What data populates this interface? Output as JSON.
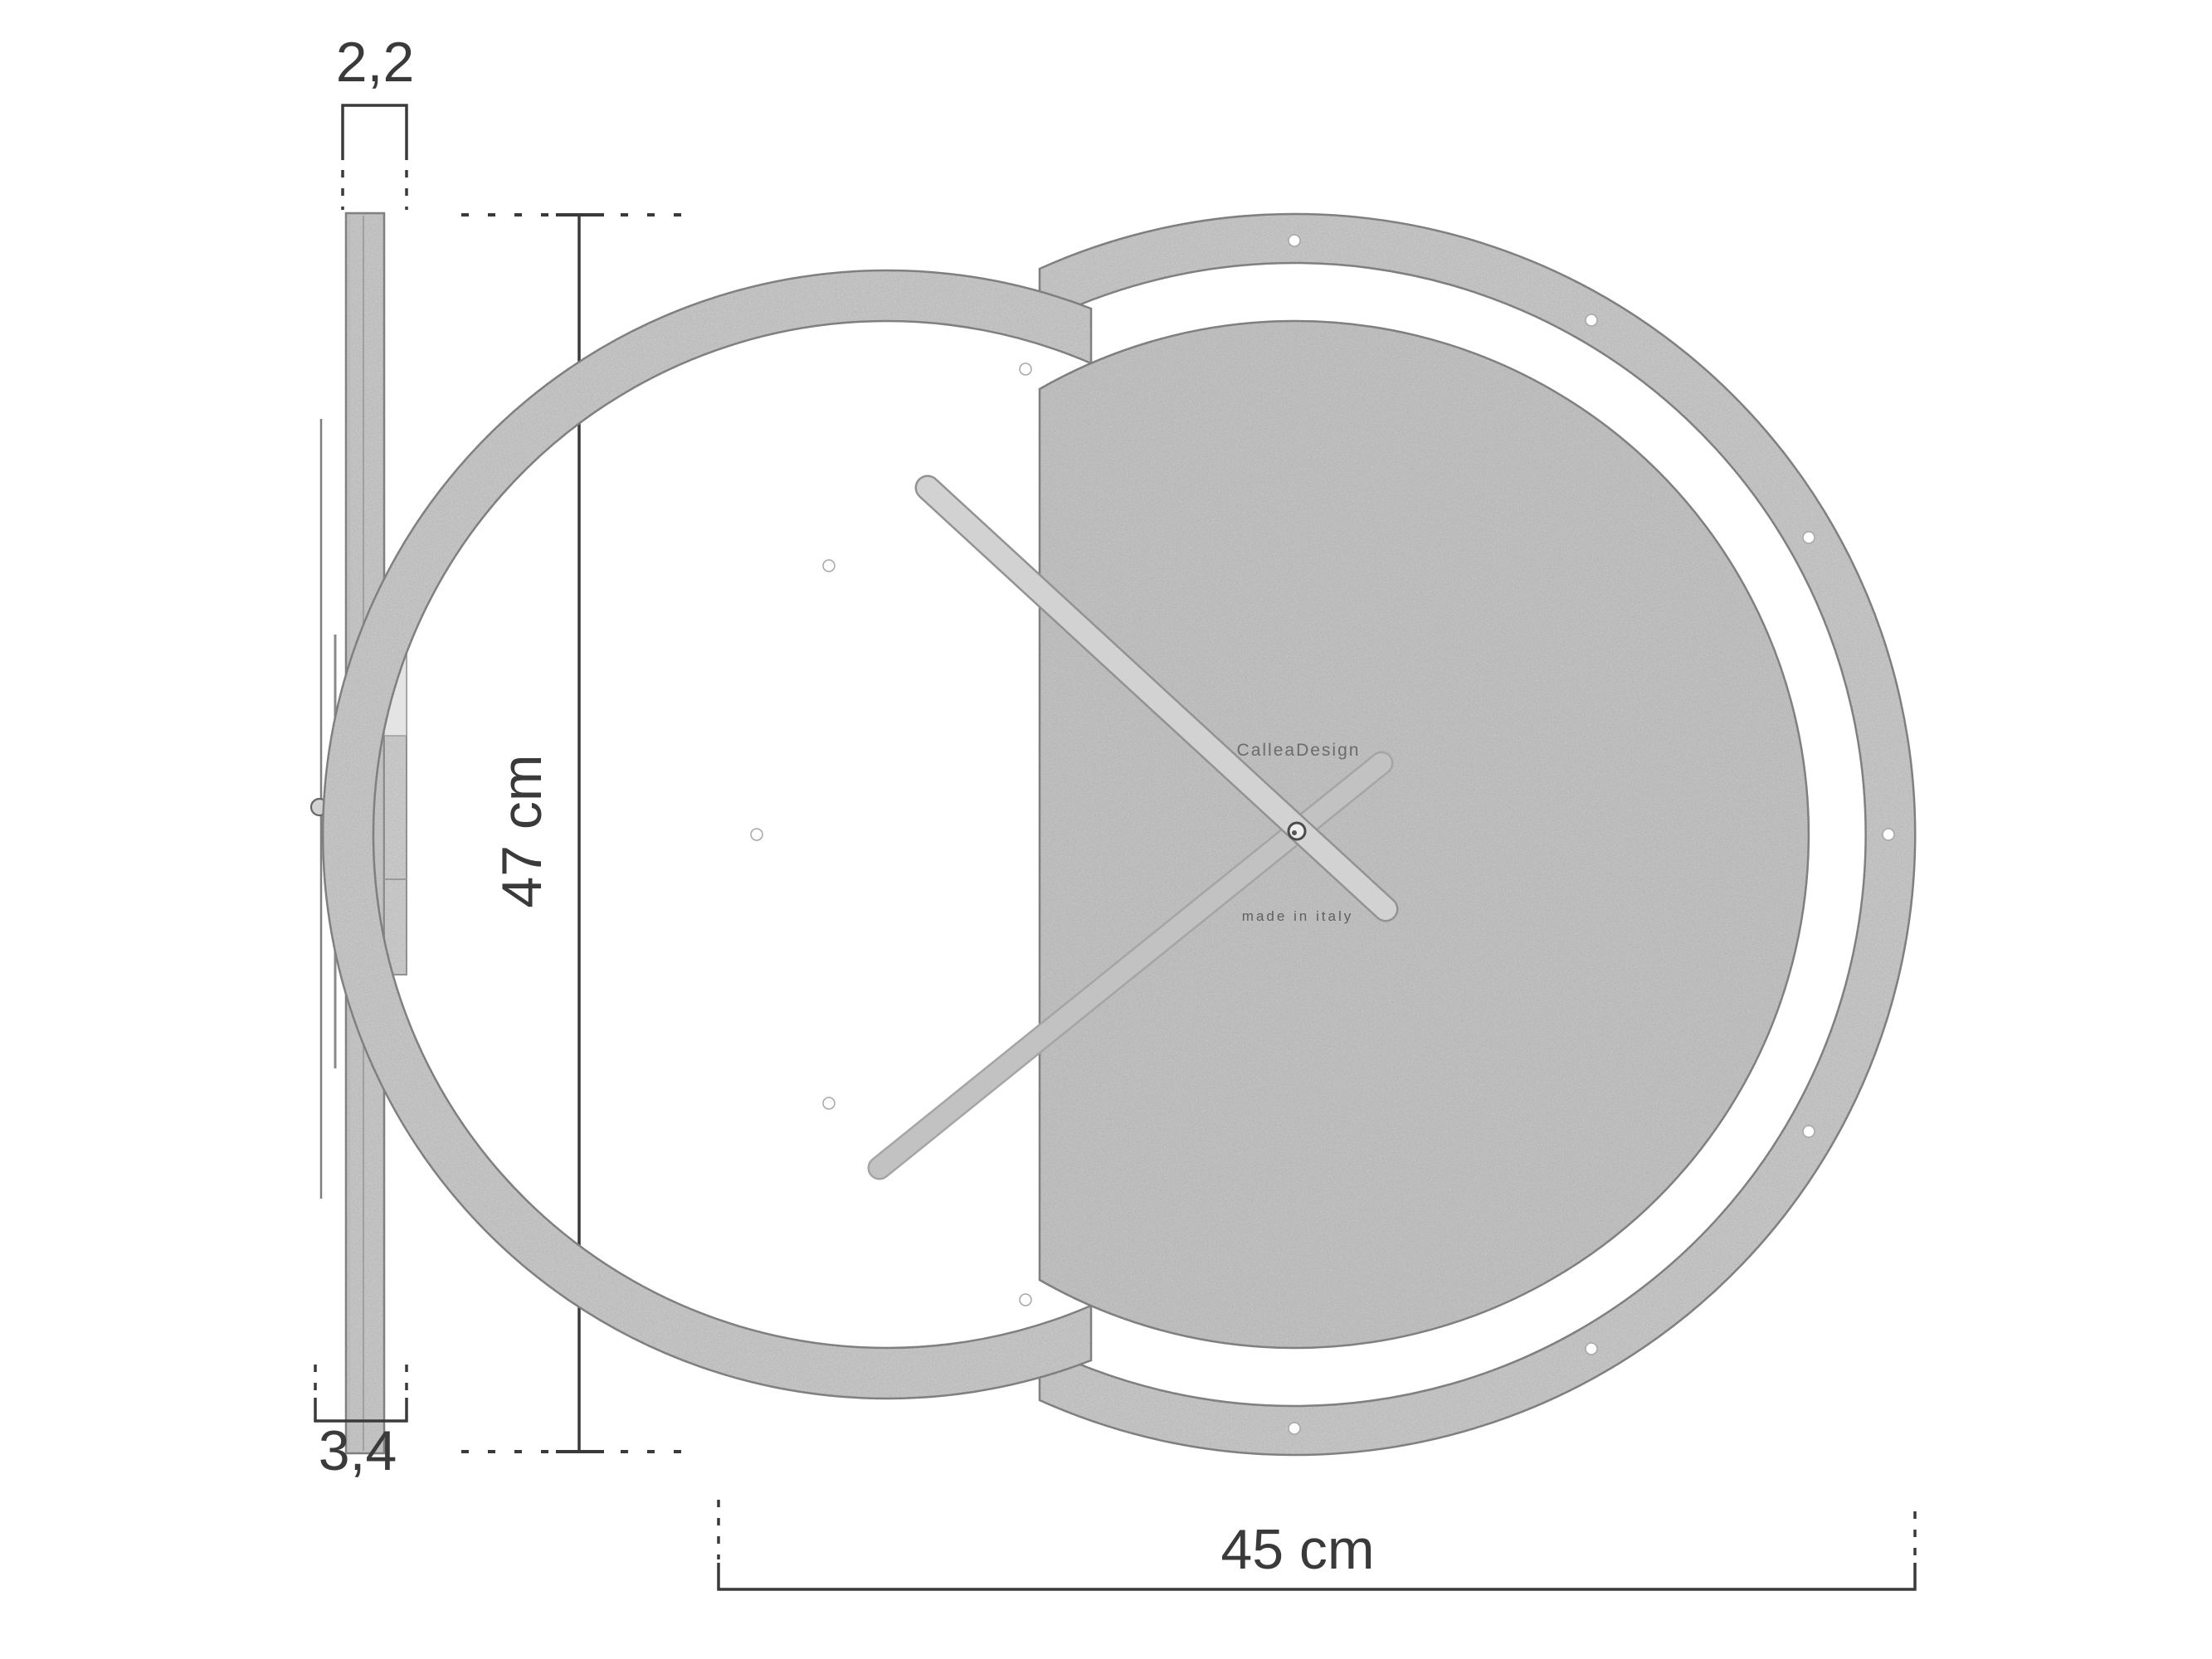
{
  "drawing": {
    "type": "technical dimensional drawing",
    "subject": "round wall clock, side profile view and front view",
    "brand": "CalleaDesign",
    "made_in": "made in italy",
    "dims": {
      "side_thickness": "2,2",
      "side_depth": "3,4",
      "height": "47 cm",
      "width": "45 cm"
    }
  },
  "colors": {
    "line": "#3a3a3a",
    "wood": "#d4d4d4",
    "wood_dark": "#cfcfcf",
    "edge": "#8d8d8d",
    "hand_light": "#d2d2d2",
    "hand_mid": "#c2c2c2",
    "text_brand": "#6b6b6b",
    "text_made": "#5f5f5f"
  }
}
